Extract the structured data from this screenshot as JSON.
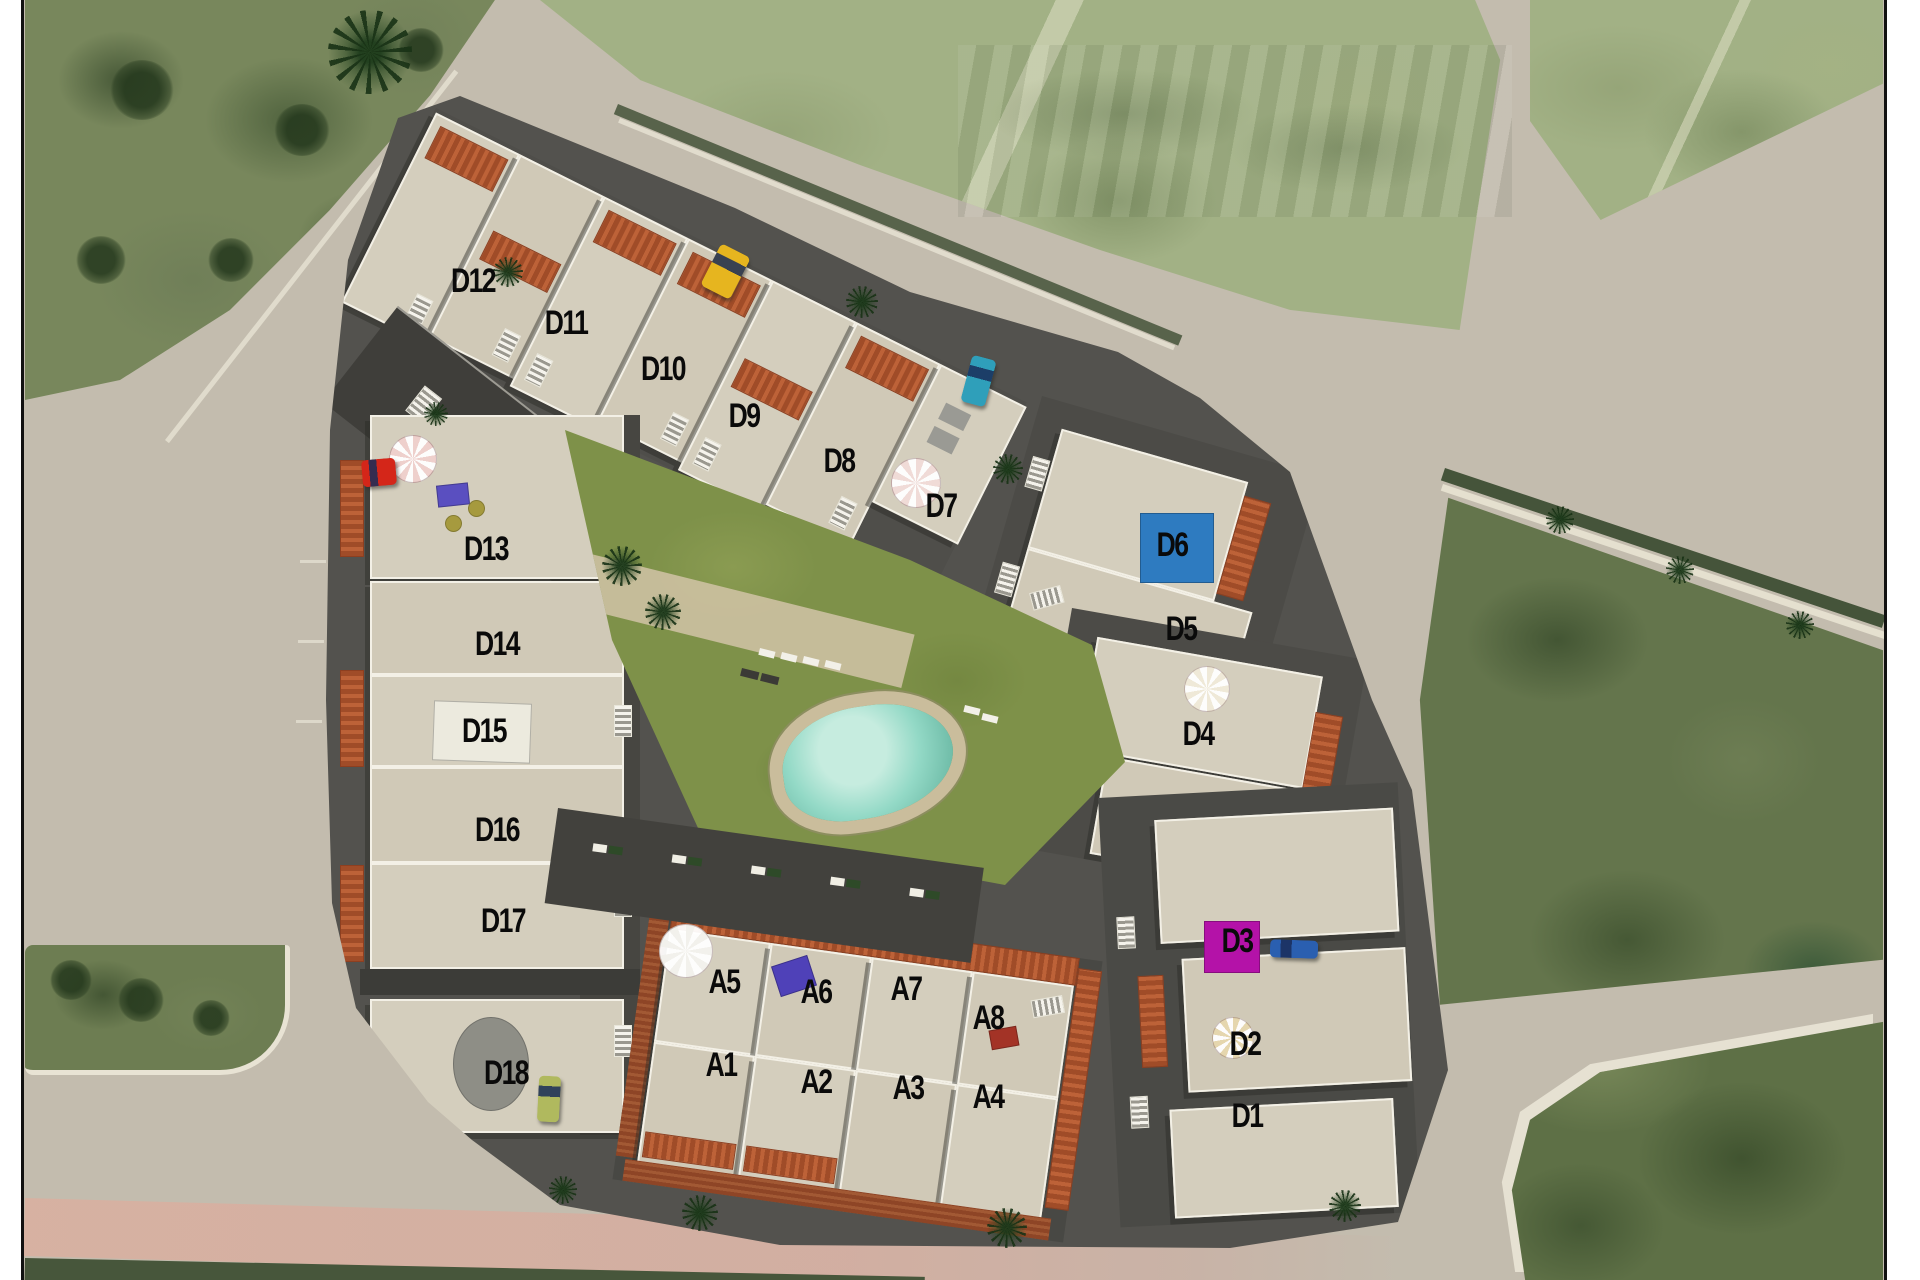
{
  "figure": {
    "type": "aerial-development-site-plan",
    "description": "Satellite photo with 3D render of a residential complex, central pool courtyard and labelled units"
  },
  "palette": {
    "asphalt": "#c3bcae",
    "roof_light": "#d4cebd",
    "wall_white": "#f3f0e6",
    "site_street": "#53524e",
    "tile_red": "#a04c28",
    "brick_red": "#8e4526",
    "lawn_green": "#7e9149",
    "pool_water": "#93d9c6",
    "pool_deck": "#cabd9c",
    "field_green_dark": "#64754c",
    "field_green_light": "#a2b185",
    "marker_blue": "#2e7bc0",
    "marker_magenta": "#b412a8",
    "parasol_pink": "#eed0cc",
    "parasol_tan": "#e5d6ae",
    "car_red": "#d42619",
    "car_yellow": "#e6b51f",
    "car_teal": "#2f9fba",
    "car_blue": "#2a5fb0",
    "car_olive": "#b0b95e",
    "road_pink": "#d9b0a0"
  },
  "units": {
    "d_series": [
      {
        "id": "D1",
        "x": 1247,
        "y": 1116
      },
      {
        "id": "D2",
        "x": 1245,
        "y": 1044
      },
      {
        "id": "D3",
        "x": 1237,
        "y": 941
      },
      {
        "id": "D4",
        "x": 1198,
        "y": 734
      },
      {
        "id": "D5",
        "x": 1181,
        "y": 629
      },
      {
        "id": "D6",
        "x": 1172,
        "y": 545
      },
      {
        "id": "D7",
        "x": 941,
        "y": 506
      },
      {
        "id": "D8",
        "x": 839,
        "y": 461
      },
      {
        "id": "D9",
        "x": 744,
        "y": 416
      },
      {
        "id": "D10",
        "x": 663,
        "y": 369
      },
      {
        "id": "D11",
        "x": 566,
        "y": 323
      },
      {
        "id": "D12",
        "x": 473,
        "y": 281
      },
      {
        "id": "D13",
        "x": 486,
        "y": 549
      },
      {
        "id": "D14",
        "x": 497,
        "y": 644
      },
      {
        "id": "D15",
        "x": 484,
        "y": 731
      },
      {
        "id": "D16",
        "x": 497,
        "y": 830
      },
      {
        "id": "D17",
        "x": 503,
        "y": 921
      },
      {
        "id": "D18",
        "x": 506,
        "y": 1073
      }
    ],
    "a_series": [
      {
        "id": "A1",
        "x": 721,
        "y": 1065
      },
      {
        "id": "A2",
        "x": 816,
        "y": 1082
      },
      {
        "id": "A3",
        "x": 908,
        "y": 1088
      },
      {
        "id": "A4",
        "x": 988,
        "y": 1097
      },
      {
        "id": "A5",
        "x": 724,
        "y": 982
      },
      {
        "id": "A6",
        "x": 816,
        "y": 992
      },
      {
        "id": "A7",
        "x": 906,
        "y": 989
      },
      {
        "id": "A8",
        "x": 988,
        "y": 1018
      }
    ]
  },
  "markers": [
    {
      "name": "rooftop-pool-square-d6",
      "shape": "rect",
      "x": 1140,
      "y": 513,
      "w": 72,
      "h": 68,
      "color": "#2e7bc0",
      "rot": 0
    },
    {
      "name": "magenta-canopy-d3",
      "shape": "rect",
      "x": 1204,
      "y": 921,
      "w": 54,
      "h": 50,
      "color": "#b412a8",
      "rot": 0
    },
    {
      "name": "white-roof-panel-d15",
      "shape": "rect",
      "x": 433,
      "y": 702,
      "w": 96,
      "h": 58,
      "color": "#eceade",
      "rot": 2
    },
    {
      "name": "round-tower-d18",
      "shape": "ellipse",
      "x": 453,
      "y": 1017,
      "w": 74,
      "h": 92,
      "color": "#8e8e86",
      "rot": 0
    },
    {
      "name": "pink-parasol-d13",
      "shape": "parasol",
      "x": 389,
      "y": 435,
      "w": 46,
      "h": 46,
      "color": "#eed0cc",
      "rot": 0
    },
    {
      "name": "purple-table-d13",
      "shape": "rect",
      "x": 437,
      "y": 484,
      "w": 30,
      "h": 20,
      "color": "#5a4fc0",
      "rot": -6
    },
    {
      "name": "olive-seat-1-d13",
      "shape": "ellipse",
      "x": 445,
      "y": 515,
      "w": 15,
      "h": 15,
      "color": "#a69a3e",
      "rot": 0
    },
    {
      "name": "olive-seat-2-d13",
      "shape": "ellipse",
      "x": 468,
      "y": 500,
      "w": 15,
      "h": 15,
      "color": "#a69a3e",
      "rot": 0
    },
    {
      "name": "pink-parasol-d7",
      "shape": "octagon",
      "x": 891,
      "y": 458,
      "w": 48,
      "h": 48,
      "color": "#f0dbd7",
      "rot": 0
    },
    {
      "name": "white-parasol-a5",
      "shape": "parasol",
      "x": 659,
      "y": 924,
      "w": 52,
      "h": 52,
      "color": "#f2f1ec",
      "rot": 0
    },
    {
      "name": "white-parasol-d4",
      "shape": "parasol",
      "x": 1184,
      "y": 666,
      "w": 44,
      "h": 44,
      "color": "#efe9d8",
      "rot": 0
    },
    {
      "name": "tan-parasol-d2",
      "shape": "parasol",
      "x": 1212,
      "y": 1017,
      "w": 40,
      "h": 40,
      "color": "#e5d6ae",
      "rot": 0
    },
    {
      "name": "purple-table-a6",
      "shape": "rect",
      "x": 775,
      "y": 960,
      "w": 36,
      "h": 30,
      "color": "#4f41b8",
      "rot": -18
    },
    {
      "name": "red-patio-set-a4",
      "shape": "rect",
      "x": 990,
      "y": 1028,
      "w": 26,
      "h": 18,
      "color": "#a33326",
      "rot": -10
    },
    {
      "name": "car-red",
      "shape": "car",
      "x": 362,
      "y": 459,
      "w": 34,
      "h": 27,
      "color": "#d42619",
      "rot": -5
    },
    {
      "name": "car-yellow",
      "shape": "car",
      "x": 709,
      "y": 248,
      "w": 33,
      "h": 47,
      "color": "#e6b51f",
      "rot": 27
    },
    {
      "name": "car-teal",
      "shape": "car",
      "x": 966,
      "y": 357,
      "w": 25,
      "h": 48,
      "color": "#2f9fba",
      "rot": 15
    },
    {
      "name": "car-blue",
      "shape": "car",
      "x": 1270,
      "y": 940,
      "w": 48,
      "h": 18,
      "color": "#2a5fb0",
      "rot": 2
    },
    {
      "name": "car-olive",
      "shape": "car",
      "x": 538,
      "y": 1076,
      "w": 22,
      "h": 46,
      "color": "#b0b95e",
      "rot": 3
    }
  ]
}
